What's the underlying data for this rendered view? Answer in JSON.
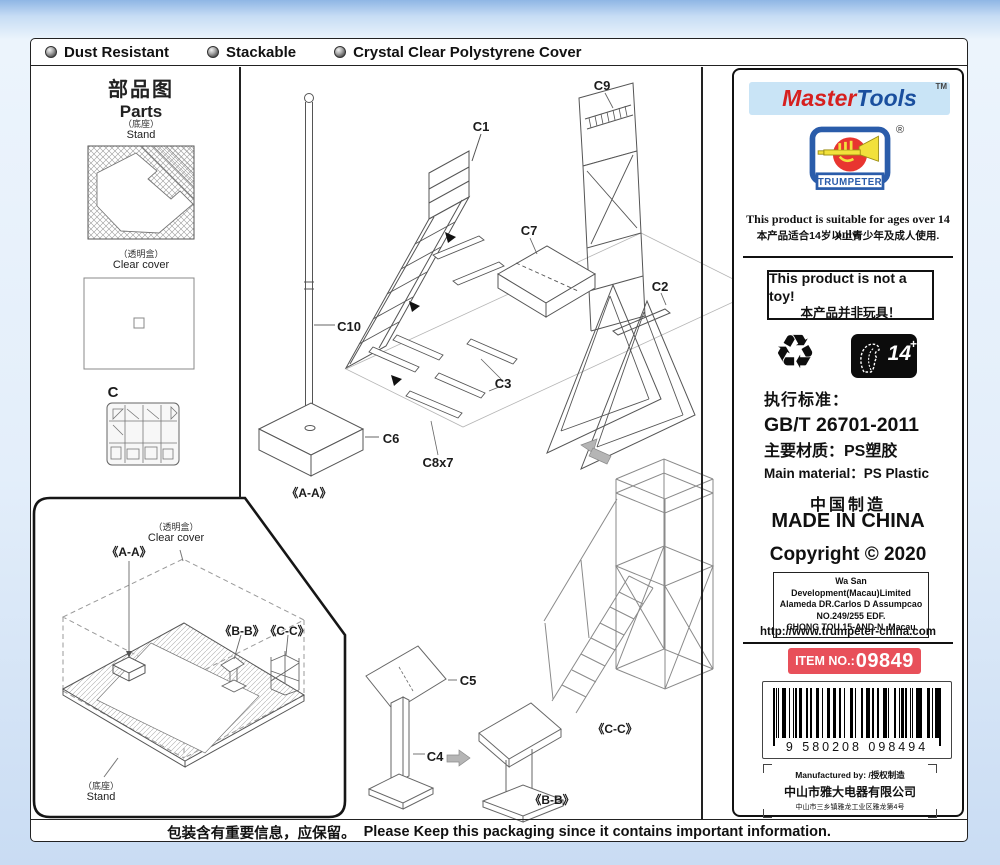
{
  "top_bar": {
    "features": [
      {
        "label": "Dust Resistant"
      },
      {
        "label": "Stackable"
      },
      {
        "label": "Crystal Clear Polystyrene Cover"
      }
    ]
  },
  "parts_panel": {
    "title_zh": "部品图",
    "title_en": "Parts",
    "stand_label_zh": "（底座）",
    "stand_label_en": "Stand",
    "cover_label_zh": "（透明盒）",
    "cover_label_en": "Clear cover",
    "sprue_label": "C"
  },
  "diagram_labels": {
    "c1": "C1",
    "c9": "C9",
    "c7": "C7",
    "c2": "C2",
    "c10": "C10",
    "c3": "C3",
    "c6": "C6",
    "c8x7": "C8x7",
    "aa": "《A-A》",
    "c5": "C5",
    "c4": "C4",
    "bb": "《B-B》",
    "cc": "《C-C》"
  },
  "assembled_panel": {
    "cover_label_zh": "（透明盒）",
    "cover_label_en": "Clear cover",
    "aa": "《A-A》",
    "bb": "《B-B》",
    "cc": "《C-C》",
    "stand_label_zh": "（底座）",
    "stand_label_en": "Stand"
  },
  "info_panel": {
    "brand_master": "Master",
    "brand_tools": "Tools",
    "brand_tm": "TM",
    "trumpeter_name": "TRUMPETER",
    "trumpeter_reg": "®",
    "age_en": "This product is suitable for ages over 14 only.",
    "age_zh": "本产品适合14岁以上青少年及成人使用.",
    "not_toy_en": "This product is not a toy!",
    "not_toy_zh": "本产品并非玩具！",
    "recycle_icon": "♻",
    "age_badge_num": "14",
    "age_badge_plus": "+",
    "standard_label": "执行标准：",
    "standard_value": "GB/T 26701-2011",
    "material_zh": "主要材质：PS塑胶",
    "material_en": "Main material：PS Plastic",
    "made_zh": "中国制造",
    "made_en": "MADE IN CHINA",
    "copyright": "Copyright © 2020",
    "address_lines": [
      "Wa San Development(Macau)Limited",
      "Alameda DR.Carlos D Assumpcao",
      "NO.249/255 EDF.",
      "CHONG TOU 15-AND-N, Macau"
    ],
    "website": "http://www.trumpeter-china.com",
    "item_no_label": "ITEM NO.:",
    "item_no_value": "09849",
    "barcode_digits": "9 580208 098494",
    "mfg_line1": "Manufactured by: /授权制造",
    "mfg_line2": "中山市雅大电器有限公司",
    "mfg_line3": "中山市三乡镇雅龙工业区雅龙第4号"
  },
  "bottom_bar": {
    "notice_zh": "包装含有重要信息，应保留。",
    "notice_en": "Please Keep this packaging since it contains important information."
  },
  "colors": {
    "brand_red": "#d6201f",
    "brand_blue": "#1a4f9e",
    "logo_bg": "#c9e4f6",
    "trumpeter_blue": "#2a5caa",
    "trumpeter_red": "#e83530",
    "trumpeter_yellow": "#f2e13c",
    "item_badge_red": "#e8505a"
  }
}
